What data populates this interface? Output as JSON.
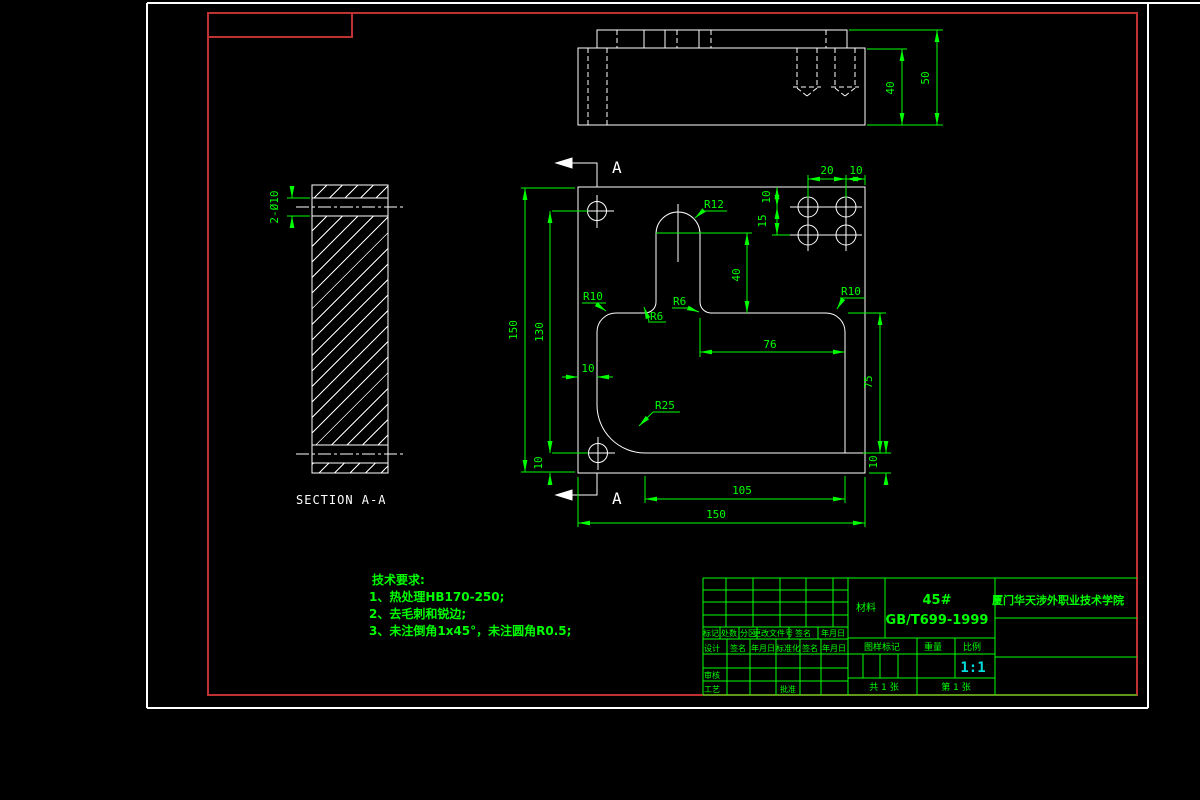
{
  "colors": {
    "background": "#000000",
    "geometry_line": "#ffffff",
    "dimension": "#00ff00",
    "frame": "#c03232",
    "scale_value_color": "#00dddd"
  },
  "section_view": {
    "label": "SECTION A-A",
    "holes_dim": "2-Ø10"
  },
  "top_view": {
    "depth_dim": "40",
    "total_height_dim": "50"
  },
  "main_view": {
    "section_letter_top": "A",
    "section_letter_bottom": "A",
    "dims": {
      "overall_height": "150",
      "inner_height": "130",
      "hole_bottom_offset": "10",
      "left_wall": "10",
      "slot_depth": "40",
      "floor_width": "76",
      "pocket_depth": "75",
      "step_height": "10",
      "step_width": "105",
      "overall_width": "150",
      "pattern_spacing_h": "20",
      "pattern_edge_h": "10",
      "pattern_top_offset": "10",
      "pattern_spacing_v": "15"
    },
    "radii": {
      "slot_top": "R12",
      "pocket_top_left": "R10",
      "slot_bottom_left": "R6",
      "slot_bottom_right": "R6",
      "pocket_top_right": "R10",
      "corner": "R25"
    }
  },
  "tech_requirements": {
    "title": "技术要求:",
    "item1": "1、热处理HB170-250;",
    "item2": "2、去毛刺和锐边;",
    "item3": "3、未注倒角1x45°，未注圆角R0.5;"
  },
  "title_block": {
    "material_label": "材料",
    "material_grade": "45#",
    "material_standard": "GB/T699-1999",
    "school_name": "厦门华天涉外职业技术学院",
    "header_row": {
      "c1": "标记",
      "c2": "处数",
      "c3": "分区",
      "c4": "更改文件号",
      "c5": "签名",
      "c6": "年月日"
    },
    "designer_row": {
      "c1": "设计",
      "c2": "签名",
      "c3": "年月日",
      "c4": "标准化",
      "c5": "签名",
      "c6": "年月日"
    },
    "reviewer_label": "审核",
    "process_label": "工艺",
    "approver_label": "批准",
    "mark_label": "图样标记",
    "weight_label": "重量",
    "scale_label": "比例",
    "scale_value": "1:1",
    "sheets_total": "共 1 张",
    "sheet_number": "第 1 张"
  }
}
